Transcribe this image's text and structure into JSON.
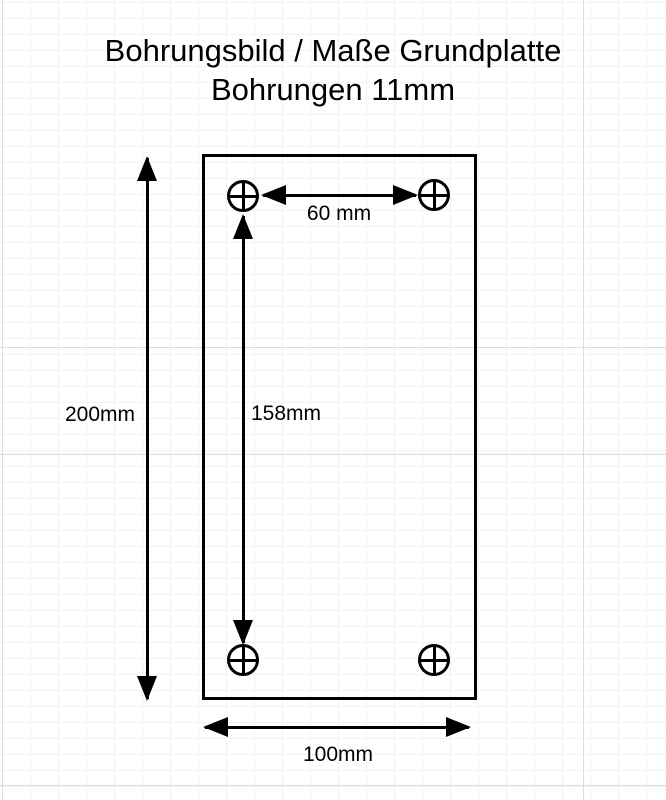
{
  "title": {
    "line1": "Bohrungsbild / Maße Grundplatte",
    "line2": "Bohrungen 11mm"
  },
  "diagram": {
    "type": "technical-drawing",
    "holes": {
      "count": 4,
      "symbol": "circle-crosshair"
    },
    "dimensions": [
      {
        "name": "hole-spacing-horizontal",
        "label": "60 mm"
      },
      {
        "name": "hole-spacing-vertical",
        "label": "158mm"
      },
      {
        "name": "plate-height",
        "label": "200mm"
      },
      {
        "name": "plate-width",
        "label": "100mm"
      }
    ]
  },
  "colors": {
    "line": "#000000",
    "background": "#ffffff",
    "grid_minor": "#f3f3f3",
    "grid_major": "#dcdcdc"
  }
}
